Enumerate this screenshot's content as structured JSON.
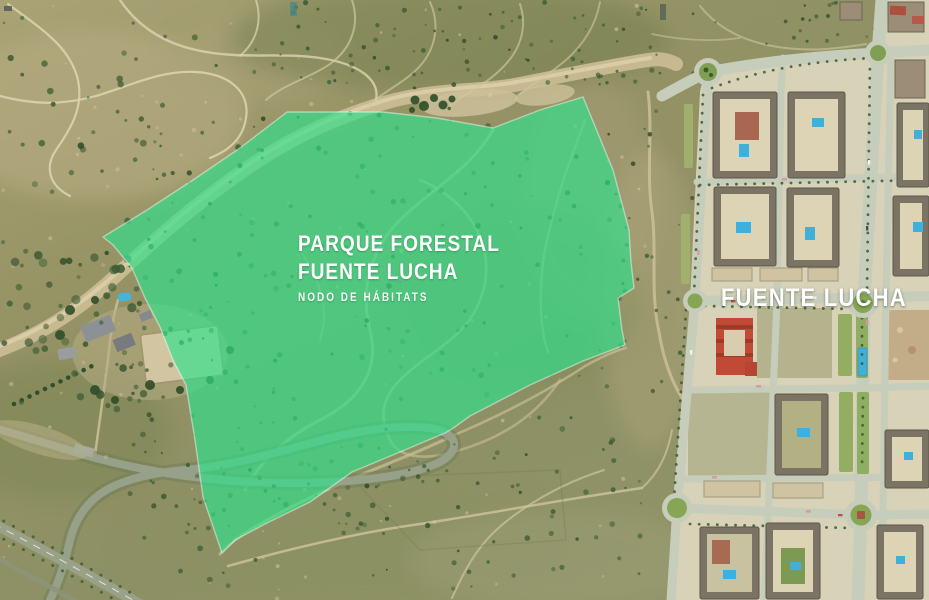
{
  "labels": {
    "park_title_line1": "PARQUE FORESTAL",
    "park_title_line2": "FUENTE LUCHA",
    "park_subtitle": "NODO DE HÁBITATS",
    "district": "FUENTE LUCHA"
  },
  "park_overlay": {
    "fill": "#2fe08c",
    "fill_opacity": "0.66",
    "stroke": "rgba(255,255,255,0.45)"
  }
}
